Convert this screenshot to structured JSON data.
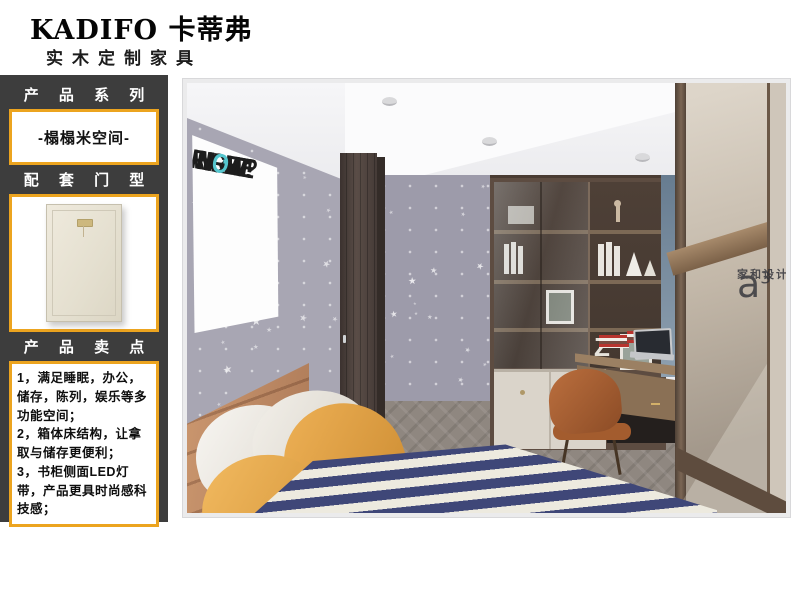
{
  "brand": {
    "logo_text": "KADIFO 卡蒂弗",
    "subtitle": "实木定制家具"
  },
  "sidebar": {
    "series_title": "产 品 系 列",
    "series_value": "-榻榻米空间-",
    "door_title": "配 套 门 型",
    "selling_title": "产 品 卖 点",
    "selling_points": [
      "1，满足睡眠，办公，储存，陈列，娱乐等多功能空间；",
      "2，箱体床结构，让拿取与储存更便利；",
      "3，书柜侧面LED灯带，产品更具时尚感科技感；"
    ]
  },
  "photo": {
    "poster_lines": [
      "WRITE",
      "NOW?",
      "RIGHT",
      "NOW!"
    ],
    "watermark_logo": "a",
    "watermark_sup": "3",
    "watermark_name": "家和设计"
  },
  "colors": {
    "accent_gold": "#eca41f",
    "sidebar_bg": "#3d3d3d",
    "poster_teal": "#55c6ce",
    "duvet_navy": "#3f4778",
    "pillow_yellow": "#d6973c",
    "wall_lavender": "#a8a6b3"
  }
}
